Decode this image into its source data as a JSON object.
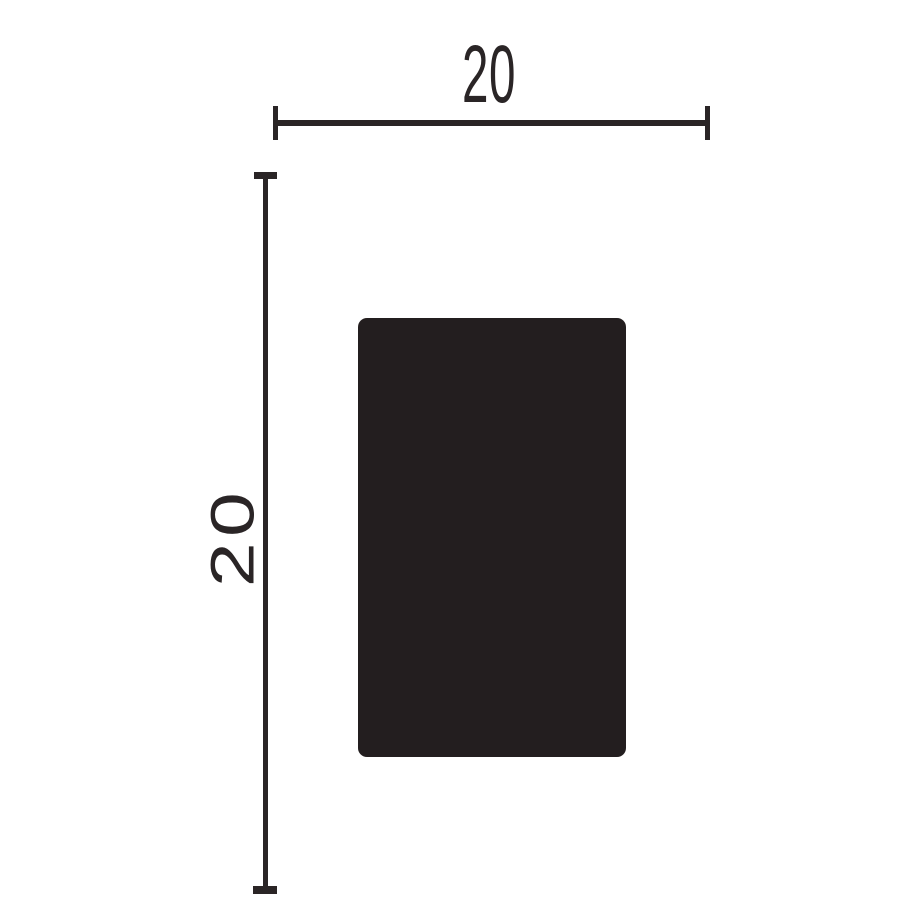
{
  "drawing": {
    "description": "dimensioned technical drawing of rectangular profile cross-section",
    "width_label": "20",
    "height_label": "20",
    "ink_color": "#2a2526",
    "profile_fill": "#231e1f",
    "background_color": "#ffffff"
  }
}
